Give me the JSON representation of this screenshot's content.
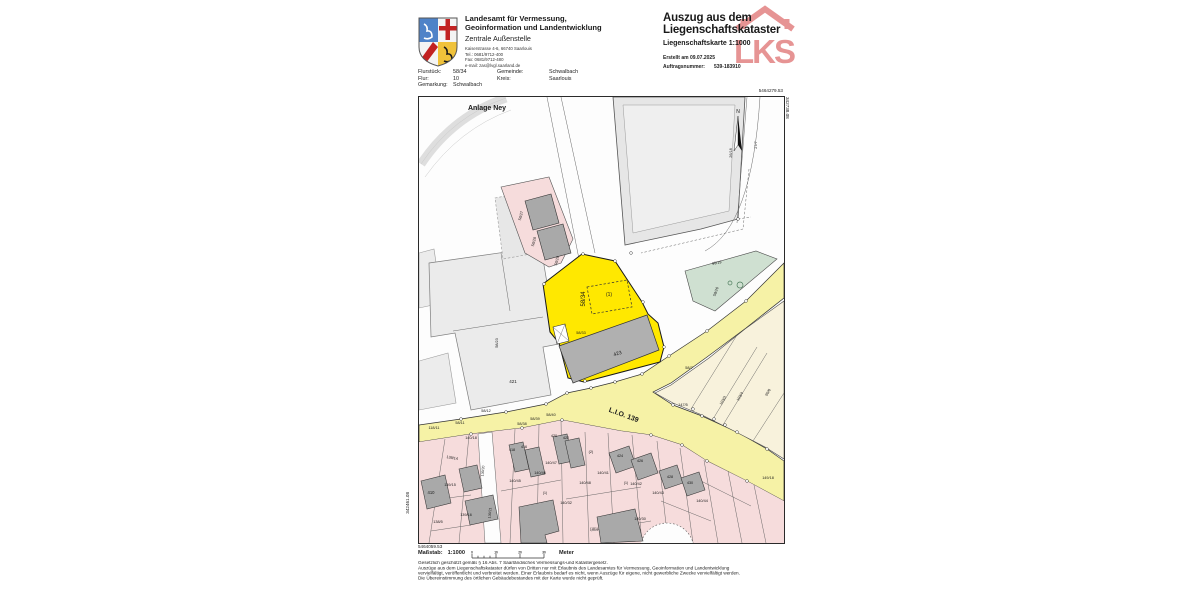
{
  "header": {
    "agency": {
      "line1": "Landesamt für Vermessung,",
      "line2": "Geoinformation und Landentwicklung",
      "office": "Zentrale Außenstelle",
      "address": "Kaiserstrasse 4-6, 66740 Saarlouis",
      "tel": "Tel.: 0681/9712-400",
      "fax": "Fax: 0681/9712-480",
      "email": "e-mail: zas@lvgl.saarland.de"
    },
    "title_line1": "Auszug aus dem",
    "title_line2": "Liegenschaftskataster",
    "subtitle": "Liegenschaftskarte  1:1000",
    "created": "Erstellt am  09.07.2025",
    "order_label": "Auftragsnummer:",
    "order_value": "539-183910",
    "watermark": "LKS",
    "fields": [
      {
        "label": "Flurstück:",
        "value": "58/34"
      },
      {
        "label": "Flur:",
        "value": "10"
      },
      {
        "label": "Gemarkung:",
        "value": "Schwalbach"
      },
      {
        "label": "Gemeinde:",
        "value": "Schwalbach"
      },
      {
        "label": "Kreis:",
        "value": "Saarlouis"
      }
    ]
  },
  "map": {
    "corner_coords": {
      "top_right": "5464279.53",
      "right_vertical": "342738.08",
      "bottom_left": "5464059.53",
      "left_vertical": "342461.08"
    },
    "labels": [
      {
        "t": "Anlage Ney",
        "x": 486,
        "y": 109,
        "s": 7,
        "b": 1
      },
      {
        "t": "N",
        "x": 737,
        "y": 112,
        "s": 5
      },
      {
        "t": "26/18",
        "x": 731,
        "y": 152,
        "s": 3.8,
        "r": -90
      },
      {
        "t": "27/7",
        "x": 756,
        "y": 144,
        "s": 3.8,
        "r": -90
      },
      {
        "t": "96/19",
        "x": 716,
        "y": 263,
        "s": 3.8,
        "r": -12
      },
      {
        "t": "58/26",
        "x": 716,
        "y": 291,
        "s": 3.8,
        "r": -70
      },
      {
        "t": "58/27",
        "x": 521,
        "y": 215,
        "s": 3.8,
        "r": -75
      },
      {
        "t": "58/28",
        "x": 534,
        "y": 241,
        "s": 3.8,
        "r": -75
      },
      {
        "t": "58/29",
        "x": 557,
        "y": 260,
        "s": 3.8,
        "r": -75
      },
      {
        "t": "58/34",
        "x": 584,
        "y": 298,
        "s": 6,
        "r": -90
      },
      {
        "t": "(1)",
        "x": 608,
        "y": 295,
        "s": 5
      },
      {
        "t": "58/33",
        "x": 580,
        "y": 333,
        "s": 3.8
      },
      {
        "t": "423",
        "x": 617,
        "y": 354,
        "s": 5,
        "r": -18
      },
      {
        "t": "58/23",
        "x": 497,
        "y": 342,
        "s": 3.8,
        "r": -90
      },
      {
        "t": "421",
        "x": 512,
        "y": 382,
        "s": 4.5
      },
      {
        "t": "58/7",
        "x": 688,
        "y": 368,
        "s": 3.8
      },
      {
        "t": "L.I.O. 139",
        "x": 622,
        "y": 416,
        "s": 7,
        "b": 1,
        "r": 20
      },
      {
        "t": "147/5",
        "x": 682,
        "y": 405,
        "s": 3.8
      },
      {
        "t": "103/3",
        "x": 723,
        "y": 400,
        "s": 3.8,
        "r": -60
      },
      {
        "t": "103/4",
        "x": 740,
        "y": 396,
        "s": 3.8,
        "r": -60
      },
      {
        "t": "99/6",
        "x": 768,
        "y": 392,
        "s": 3.8,
        "r": -60
      },
      {
        "t": "149/18",
        "x": 767,
        "y": 478,
        "s": 3.8
      },
      {
        "t": "118/11",
        "x": 433,
        "y": 428,
        "s": 3.8
      },
      {
        "t": "58/11",
        "x": 459,
        "y": 423,
        "s": 3.8
      },
      {
        "t": "58/12",
        "x": 485,
        "y": 411,
        "s": 3.8
      },
      {
        "t": "58/38",
        "x": 521,
        "y": 424,
        "s": 3.8
      },
      {
        "t": "58/39",
        "x": 534,
        "y": 419,
        "s": 3.8
      },
      {
        "t": "58/40",
        "x": 550,
        "y": 415,
        "s": 3.8
      },
      {
        "t": "140/18",
        "x": 470,
        "y": 438,
        "s": 3.8
      },
      {
        "t": "139/14",
        "x": 451,
        "y": 458,
        "s": 3.8,
        "r": 10
      },
      {
        "t": "139/15",
        "x": 449,
        "y": 485,
        "s": 3.8
      },
      {
        "t": "410",
        "x": 430,
        "y": 493,
        "s": 4.2
      },
      {
        "t": "139/16",
        "x": 465,
        "y": 515,
        "s": 3.8
      },
      {
        "t": "138/5",
        "x": 437,
        "y": 522,
        "s": 3.8
      },
      {
        "t": "139/20",
        "x": 483,
        "y": 470,
        "s": 3.5,
        "r": -85
      },
      {
        "t": "139/21",
        "x": 490,
        "y": 512,
        "s": 3.5,
        "r": -85
      },
      {
        "t": "418",
        "x": 511,
        "y": 450,
        "s": 3.8
      },
      {
        "t": "416",
        "x": 523,
        "y": 447,
        "s": 3.8
      },
      {
        "t": "420",
        "x": 553,
        "y": 436,
        "s": 3.8
      },
      {
        "t": "422",
        "x": 565,
        "y": 438,
        "s": 3.8
      },
      {
        "t": "140/47",
        "x": 550,
        "y": 463,
        "s": 3.8
      },
      {
        "t": "140/46",
        "x": 539,
        "y": 473,
        "s": 3.8
      },
      {
        "t": "140/45",
        "x": 514,
        "y": 481,
        "s": 3.8
      },
      {
        "t": "140/48",
        "x": 584,
        "y": 483,
        "s": 3.8
      },
      {
        "t": "140/41",
        "x": 602,
        "y": 473,
        "s": 3.8
      },
      {
        "t": "140/42",
        "x": 635,
        "y": 484,
        "s": 3.8
      },
      {
        "t": "140/43",
        "x": 657,
        "y": 493,
        "s": 3.8
      },
      {
        "t": "140/44",
        "x": 701,
        "y": 501,
        "s": 3.8
      },
      {
        "t": "140/32",
        "x": 565,
        "y": 503,
        "s": 3.8
      },
      {
        "t": "140/30",
        "x": 639,
        "y": 519,
        "s": 3.8
      },
      {
        "t": "424",
        "x": 619,
        "y": 456,
        "s": 3.8
      },
      {
        "t": "426",
        "x": 639,
        "y": 461,
        "s": 3.8
      },
      {
        "t": "428",
        "x": 669,
        "y": 477,
        "s": 3.8
      },
      {
        "t": "430",
        "x": 689,
        "y": 483,
        "s": 3.8
      },
      {
        "t": "(2)",
        "x": 590,
        "y": 452,
        "s": 3.8
      },
      {
        "t": "(1)",
        "x": 544,
        "y": 493,
        "s": 3.5
      },
      {
        "t": "(1)",
        "x": 625,
        "y": 483,
        "s": 3.5
      },
      {
        "t": "(181)",
        "x": 593,
        "y": 529,
        "s": 3.5
      }
    ]
  },
  "footer": {
    "scale_label": "Maßstab:",
    "scale_value": "1:1000",
    "scale_unit": "Meter",
    "scale_ticks": [
      "0",
      "10",
      "20",
      "30"
    ],
    "legal_lines": [
      "Gesetzlich geschützt gemäß § 16 Abs. 7 Saarländisches Vermessungs-und Katastergesetz.",
      "Auszüge aus dem Liegenschaftskataster dürfen von Dritten nur mit Erlaubnis des Landesamtes für Vermessung, Geoinformation und Landentwicklung",
      "vervielfältigt, veröffentlicht und verbreitet werden. Einer Erlaubnis bedarf es nicht, wenn Auszüge für eigene, nicht gewerbliche Zwecke vervielfältigt werden.",
      "Die Übereinstimmung des örtlichen Gebäudebestandes mit der Karte wurde nicht geprüft."
    ]
  },
  "colors": {
    "highlight_parcel": "#ffe800",
    "road_yellow": "#f6f2a6",
    "parcel_pink": "#f6dcdc",
    "parcel_cream": "#f8f2dc",
    "parcel_green": "#cfe0d1",
    "building_gray": "#a9a9a9",
    "watermark_red": "#cf2b2b"
  }
}
